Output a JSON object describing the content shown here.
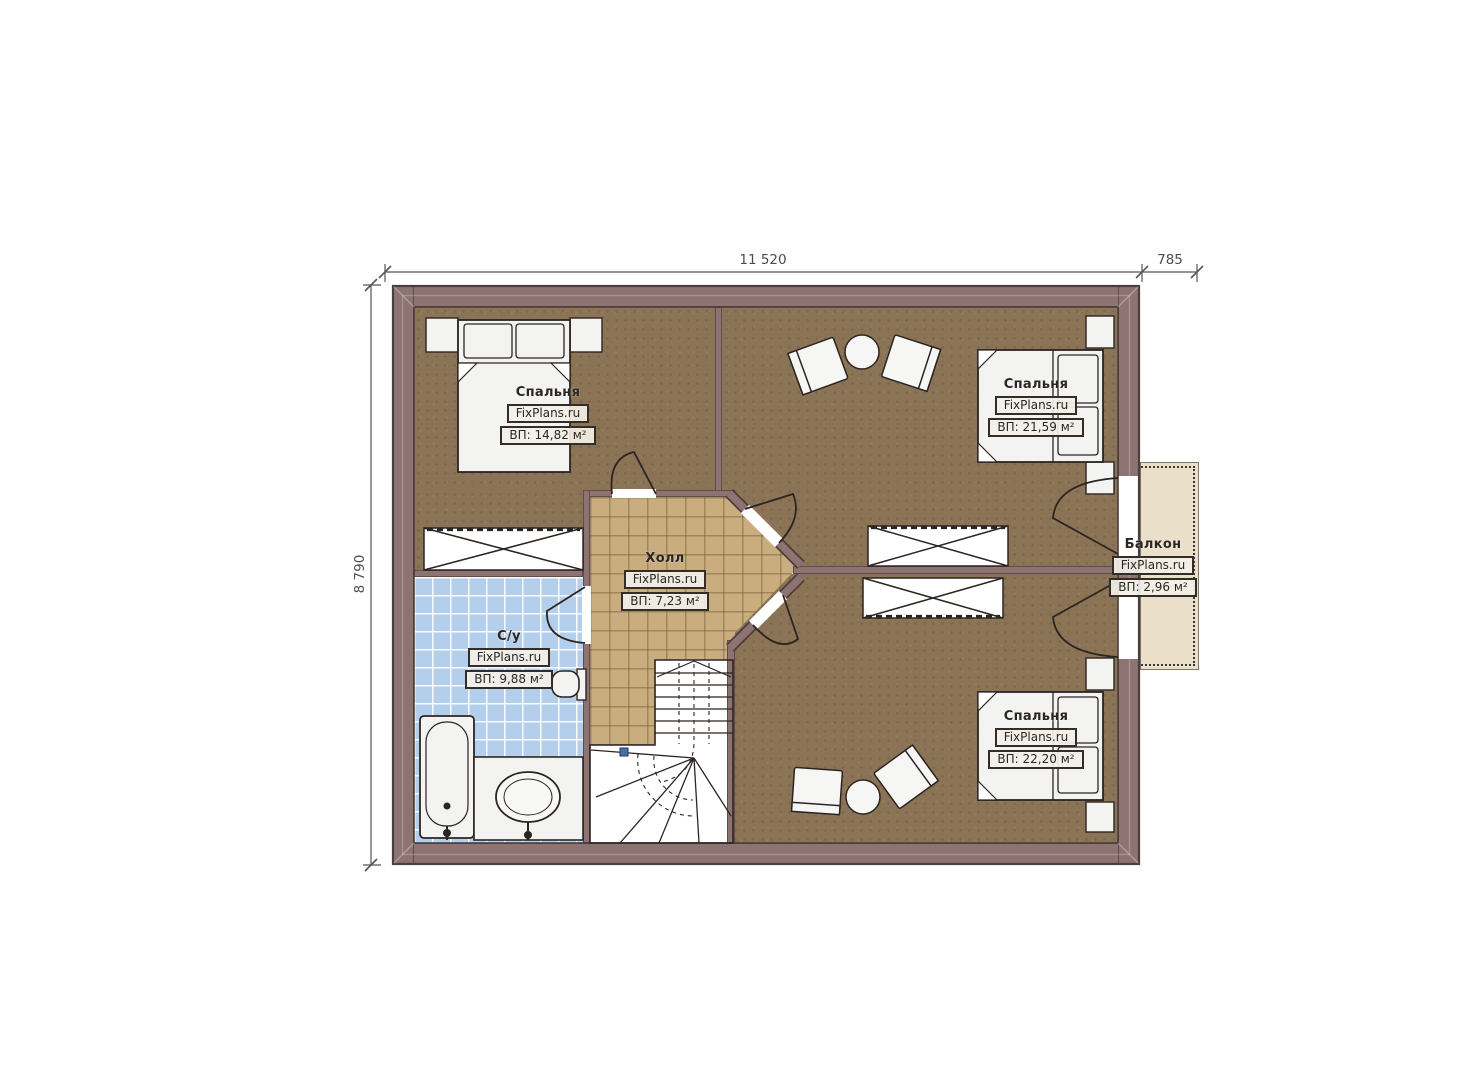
{
  "plan": {
    "type": "floor-plan",
    "dimensions": {
      "top_width": "11 520",
      "top_balcony_width": "785",
      "left_height": "8 790"
    },
    "rooms": [
      {
        "id": "bedroom-top-left",
        "name": "Спальня",
        "watermark": "FixPlans.ru",
        "area": "ВП: 14,82 м²"
      },
      {
        "id": "bedroom-top-right",
        "name": "Спальня",
        "watermark": "FixPlans.ru",
        "area": "ВП: 21,59 м²"
      },
      {
        "id": "hall",
        "name": "Холл",
        "watermark": "FixPlans.ru",
        "area": "ВП: 7,23 м²"
      },
      {
        "id": "bathroom",
        "name": "С/у",
        "watermark": "FixPlans.ru",
        "area": "ВП: 9,88 м²"
      },
      {
        "id": "bedroom-bottom-right",
        "name": "Спальня",
        "watermark": "FixPlans.ru",
        "area": "ВП: 22,20 м²"
      },
      {
        "id": "balcony",
        "name": "Балкон",
        "watermark": "FixPlans.ru",
        "area": "ВП: 2,96 м²"
      }
    ],
    "colors": {
      "wall": "#8d7372",
      "wood_floor": "#8b7355",
      "hall_tile": "#c9ad7e",
      "bathroom_tile": "#b3cfec",
      "balcony_floor": "#eadfc9",
      "furniture_fill": "#f3f3f2",
      "line": "#2b2522"
    }
  }
}
